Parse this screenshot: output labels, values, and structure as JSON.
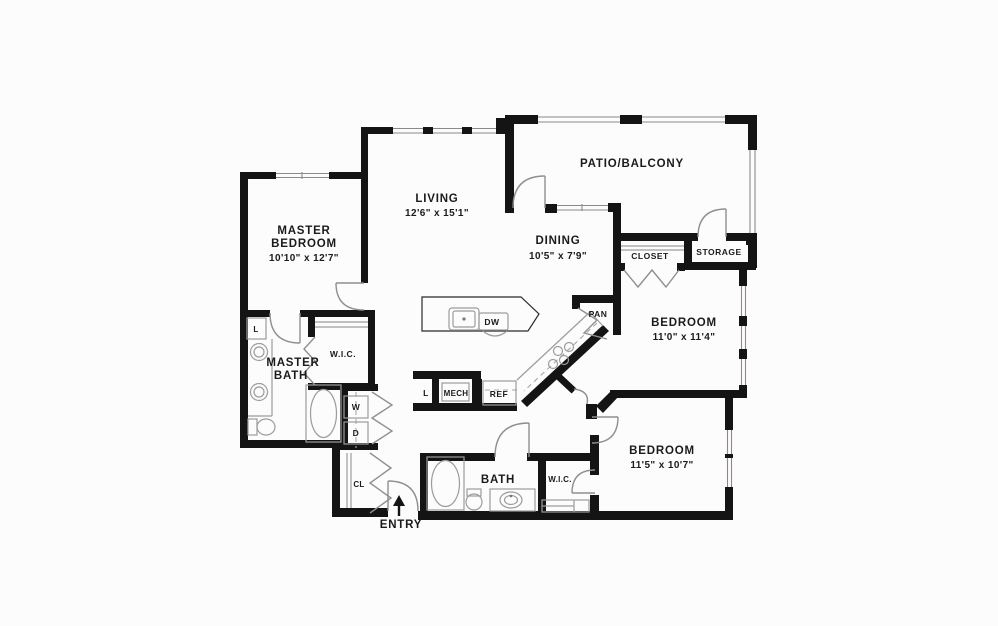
{
  "floor_plan": {
    "background": "#fdfcfc",
    "wall_color": "#141414",
    "line_color": "#9c9c9c",
    "text_color": "#1b1b1b",
    "rooms": {
      "patio": {
        "label": "PATIO/BALCONY"
      },
      "living": {
        "label": "LIVING",
        "dims": "12'6\" x 15'1\""
      },
      "master_bedroom": {
        "label_line1": "MASTER",
        "label_line2": "BEDROOM",
        "dims": "10'10\" x 12'7\""
      },
      "dining": {
        "label": "DINING",
        "dims": "10'5\" x 7'9\""
      },
      "bedroom_2": {
        "label": "BEDROOM",
        "dims": "11'0\" x 11'4\""
      },
      "bedroom_3": {
        "label": "BEDROOM",
        "dims": "11'5\" x 10'7\""
      },
      "master_bath": {
        "label_line1": "MASTER",
        "label_line2": "BATH"
      },
      "bath": {
        "label": "BATH"
      },
      "closet": {
        "label": "CLOSET"
      },
      "storage": {
        "label": "STORAGE"
      },
      "wic_master": {
        "label": "W.I.C."
      },
      "wic_bedroom3": {
        "label": "W.I.C."
      },
      "pantry": {
        "label": "PAN"
      },
      "mech": {
        "label": "MECH"
      },
      "hall_closet": {
        "label": "CL"
      },
      "entry": {
        "label": "ENTRY"
      }
    },
    "fixtures": {
      "dishwasher": "DW",
      "refrigerator": "REF",
      "washer": "W",
      "dryer": "D",
      "linen_kitchen": "L",
      "linen_master": "L"
    }
  }
}
